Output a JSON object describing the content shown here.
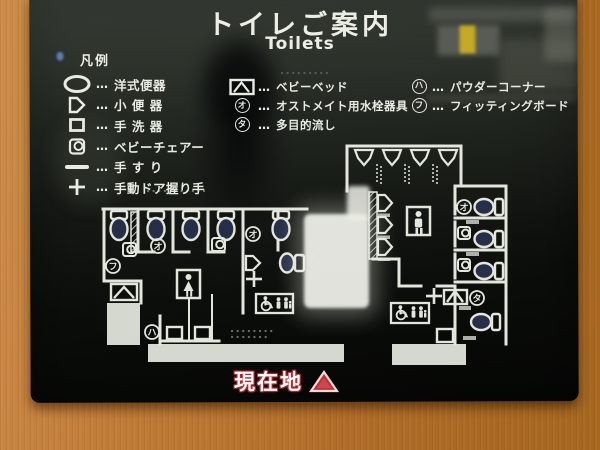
{
  "sign": {
    "title_ja": "トイレご案内",
    "title_en": "Toilets",
    "legend_header": "凡例",
    "dots": "…",
    "current_location": "現在地"
  },
  "legend": {
    "left": [
      {
        "icon": "western-toilet",
        "label": "洋式便器"
      },
      {
        "icon": "urinal",
        "label": "小 便 器"
      },
      {
        "icon": "washbasin",
        "label": "手 洗 器"
      },
      {
        "icon": "baby-chair",
        "label": "ベビーチェアー"
      },
      {
        "icon": "handrail",
        "label": "手 す り"
      },
      {
        "icon": "manual-door-handle",
        "label": "手動ドア握り手"
      }
    ],
    "middle": [
      {
        "icon": "baby-bed",
        "label": "ベビーベッド"
      },
      {
        "marker": "オ",
        "label": "オストメイト用水栓器具"
      },
      {
        "marker": "タ",
        "label": "多目的流し"
      }
    ],
    "right": [
      {
        "marker": "ハ",
        "label": "パウダーコーナー"
      },
      {
        "marker": "フ",
        "label": "フィッティングボード"
      }
    ]
  },
  "map": {
    "markers": [
      {
        "char": "オ"
      },
      {
        "char": "フ"
      },
      {
        "char": "ハ"
      },
      {
        "char": "オ"
      },
      {
        "char": "オ"
      },
      {
        "char": "タ"
      }
    ]
  },
  "colors": {
    "wall": "#b9712c",
    "line": "#e3e6dd",
    "location_red": "#c13238",
    "sign_black": "#0c0e0c"
  }
}
